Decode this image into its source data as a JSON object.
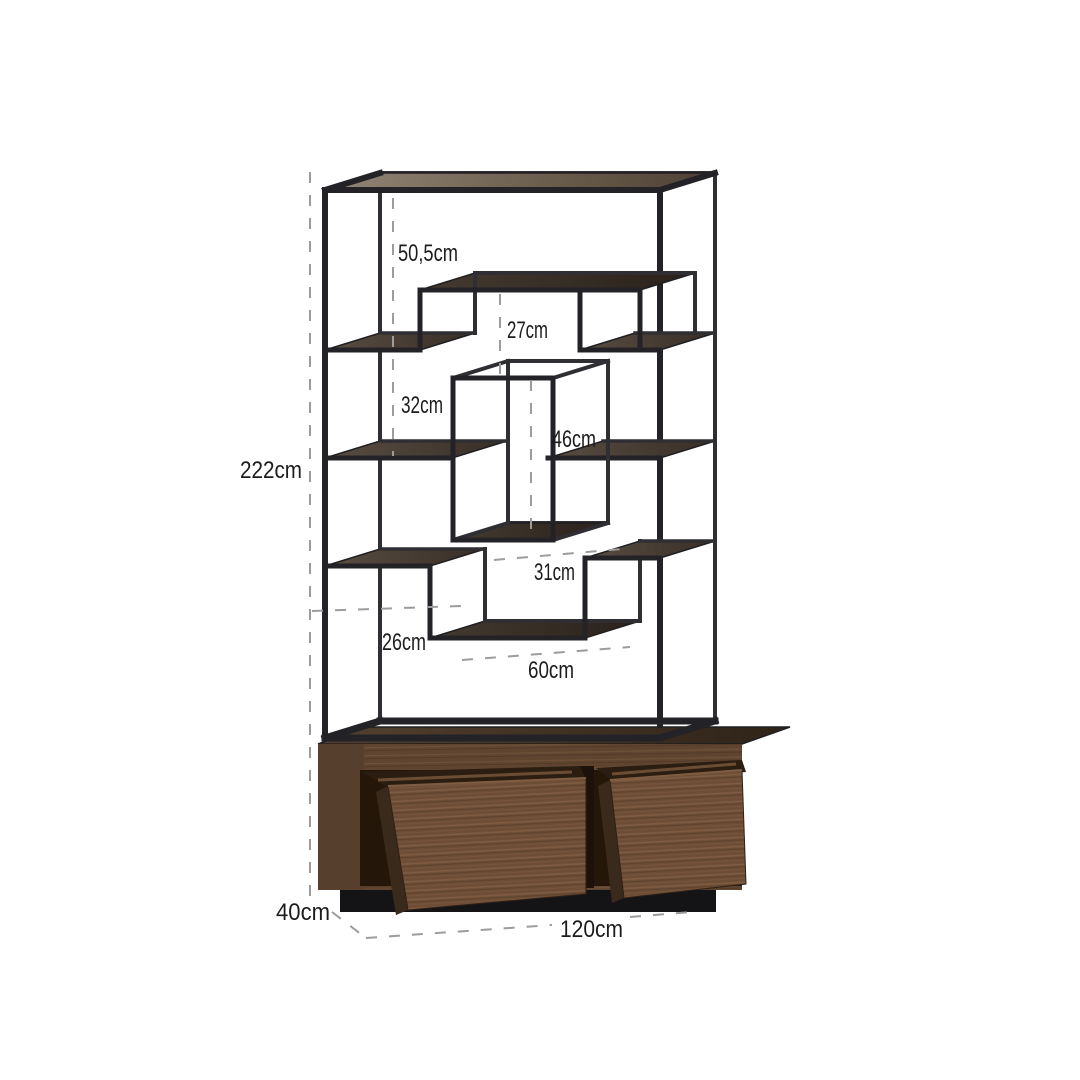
{
  "canvas": {
    "background": "#ffffff"
  },
  "dimensions": {
    "total_height": "222cm",
    "top_clearance": "50,5cm",
    "bridge_clearance": "27cm",
    "left_shelf_gap": "32cm",
    "cube_height": "46cm",
    "mid_gap": "31cm",
    "step_gap": "26cm",
    "bottom_shelf_width": "60cm",
    "depth": "40cm",
    "width": "120cm"
  },
  "colors": {
    "metal_frame": "#232327",
    "top_panel_wood": "#948678",
    "shelf_wood": "#5a4e43",
    "shelf_wood_dark": "#372e26",
    "cabinet_wood": "#6d4d36",
    "drawer_interior": "#2c1d11",
    "plinth": "#141416",
    "dash_line": "#9c9c9c",
    "label_text": "#1c1c1c"
  }
}
